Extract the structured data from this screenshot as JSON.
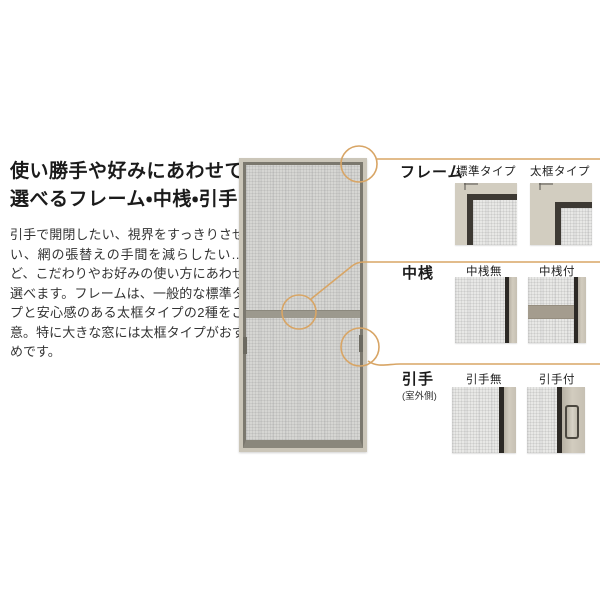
{
  "intro": {
    "heading_line1": "使い勝手や好みにあわせて",
    "heading_line2": "選べるフレーム・中桟・引手",
    "body": "引手で開閉したい、視界をすっきりさせたい、網の張替えの手間を減らしたい…など、こだわりやお好みの使い方にあわせて選べます。フレームは、一般的な標準タイプと安心感のある太框タイプの2種をご用意。特に大きな窓には太框タイプがおすすめです。"
  },
  "options": {
    "rows": [
      {
        "label": "フレーム",
        "note": "",
        "variants": [
          {
            "name": "標準タイプ"
          },
          {
            "name": "太框タイプ"
          }
        ]
      },
      {
        "label": "中桟",
        "note": "",
        "variants": [
          {
            "name": "中桟無"
          },
          {
            "name": "中桟付"
          }
        ]
      },
      {
        "label": "引手",
        "note": "(室外側)",
        "variants": [
          {
            "name": "引手無"
          },
          {
            "name": "引手付"
          }
        ]
      }
    ]
  },
  "colors": {
    "callout": "#d8a565",
    "frame_beige": "#cbc6b9",
    "frame_dark": "#3d3933",
    "mesh_gray": "#d6d6d3",
    "text": "#333333"
  }
}
